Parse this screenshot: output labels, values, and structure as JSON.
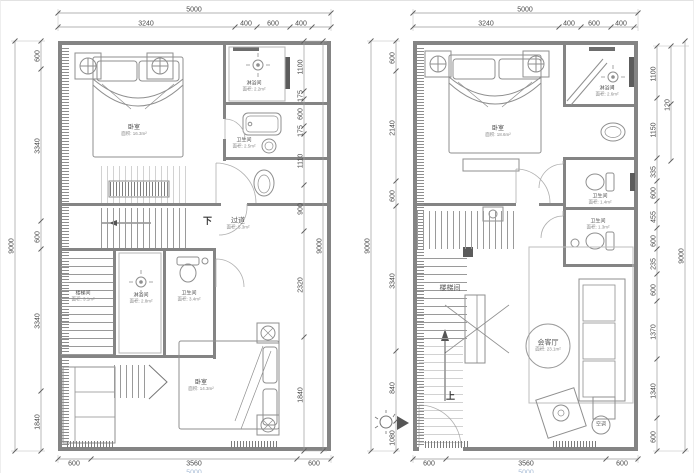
{
  "left_plan": {
    "dims": {
      "top_total": "5000",
      "top": [
        "3240",
        "400",
        "600",
        "400"
      ],
      "left_outer": "9000",
      "left": [
        "600",
        "3340",
        "600",
        "3340",
        "1840"
      ],
      "right": [
        "1100",
        "175",
        "600",
        "175",
        "1110",
        "900",
        "2320",
        "1840"
      ],
      "right_outer": "9000",
      "bottom": [
        "600",
        "3560",
        "600"
      ],
      "bottom_total": "5000"
    },
    "rooms": {
      "bedroom_top": {
        "name": "卧室",
        "area": "面积: 16.3m²"
      },
      "shower_top": {
        "name": "淋浴间",
        "area": "面积: 2.2m²"
      },
      "bath_top": {
        "name": "卫生间",
        "area": "面积: 2.5m²"
      },
      "down_label": "下",
      "corridor": {
        "name": "过道",
        "area": "面积: 5.3m²"
      },
      "stair": {
        "name": "楼梯间",
        "area": "面积: 3.1m²"
      },
      "shower_mid": {
        "name": "淋浴间",
        "area": "面积: 2.8m²"
      },
      "bath_mid": {
        "name": "卫生间",
        "area": "面积: 3.4m²"
      },
      "bedroom_bottom": {
        "name": "卧室",
        "area": "面积: 14.3m²"
      }
    }
  },
  "right_plan": {
    "dims": {
      "top_total": "5000",
      "top": [
        "3240",
        "400",
        "600",
        "400"
      ],
      "left_outer": "9000",
      "left": [
        "600",
        "2140",
        "600",
        "3340",
        "840",
        "1080"
      ],
      "right": [
        "1100",
        "1150",
        "335",
        "600",
        "455",
        "600",
        "235",
        "600",
        "1370",
        "1340",
        "600"
      ],
      "right_sub": "120",
      "right_outer": "9000",
      "bottom": [
        "600",
        "3560",
        "600"
      ],
      "bottom_total": "5000"
    },
    "rooms": {
      "bedroom": {
        "name": "卧室",
        "area": "面积: 18.6m²"
      },
      "shower": {
        "name": "淋浴间",
        "area": "面积: 2.6m²"
      },
      "bath_top": {
        "name": "卫生间",
        "area": "面积: 1.4m²"
      },
      "bath_bottom": {
        "name": "卫生间",
        "area": "面积: 1.3m²"
      },
      "stair": {
        "name": "楼梯间"
      },
      "living": {
        "name": "会客厅",
        "area": "面积: 23.1m²"
      },
      "up_label": "上",
      "ac_label": "空调"
    }
  }
}
